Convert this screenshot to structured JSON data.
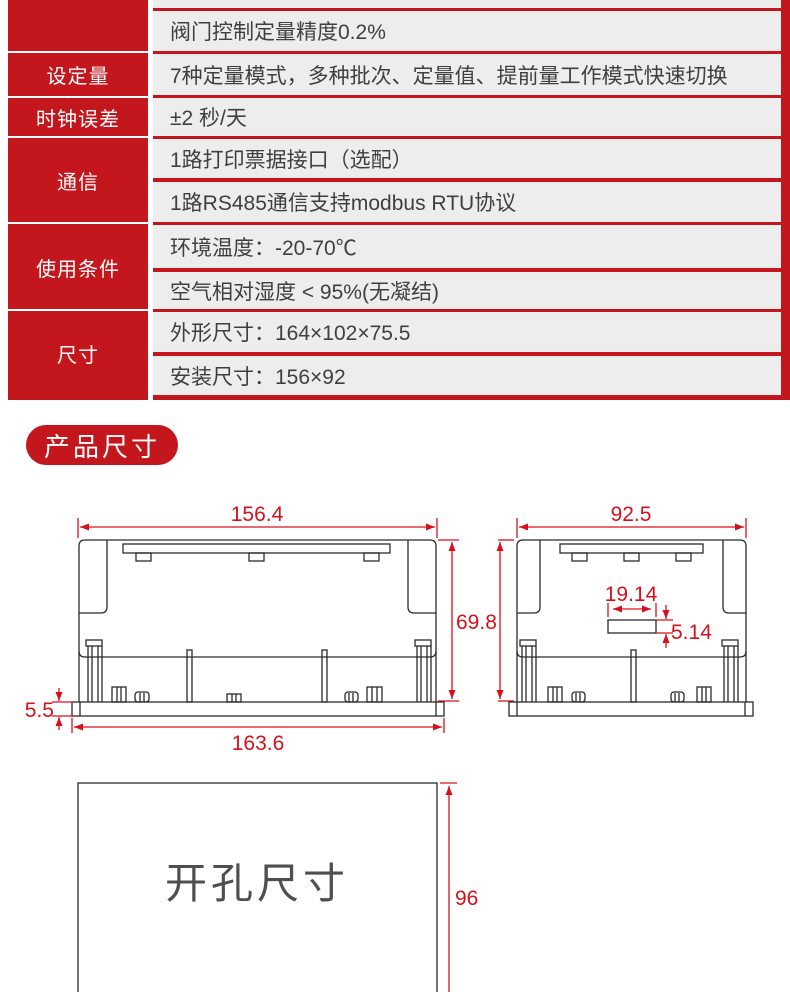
{
  "colors": {
    "brand_red": "#c4171d",
    "dimension_red": "#d8101b",
    "cell_gray": "#ededed",
    "text_dark": "#3f3f3f"
  },
  "spec_table": {
    "groups": [
      {
        "label": "",
        "rows": [
          "",
          "阀门控制定量精度0.2%"
        ]
      },
      {
        "label": "设定量",
        "rows": [
          "7种定量模式，多种批次、定量值、提前量工作模式快速切换"
        ]
      },
      {
        "label": "时钟误差",
        "rows": [
          "±2 秒/天"
        ]
      },
      {
        "label": "通信",
        "rows": [
          "1路打印票据接口（选配）",
          "1路RS485通信支持modbus RTU协议"
        ]
      },
      {
        "label": "使用条件",
        "rows": [
          "环境温度：-20-70℃",
          "空气相对湿度 < 95%(无凝结)"
        ]
      },
      {
        "label": "尺寸",
        "rows": [
          "外形尺寸：164×102×75.5",
          "安装尺寸：156×92"
        ]
      }
    ]
  },
  "section": {
    "badge_label": "产品尺寸"
  },
  "drawings": {
    "front_view": {
      "width_top": "156.4",
      "height_right": "69.8",
      "flange_height": "5.5",
      "width_bottom": "163.6"
    },
    "side_view": {
      "width_top": "92.5",
      "slot_width": "19.14",
      "slot_height": "5.14"
    },
    "cutout": {
      "label": "开孔尺寸",
      "height": "96"
    }
  }
}
